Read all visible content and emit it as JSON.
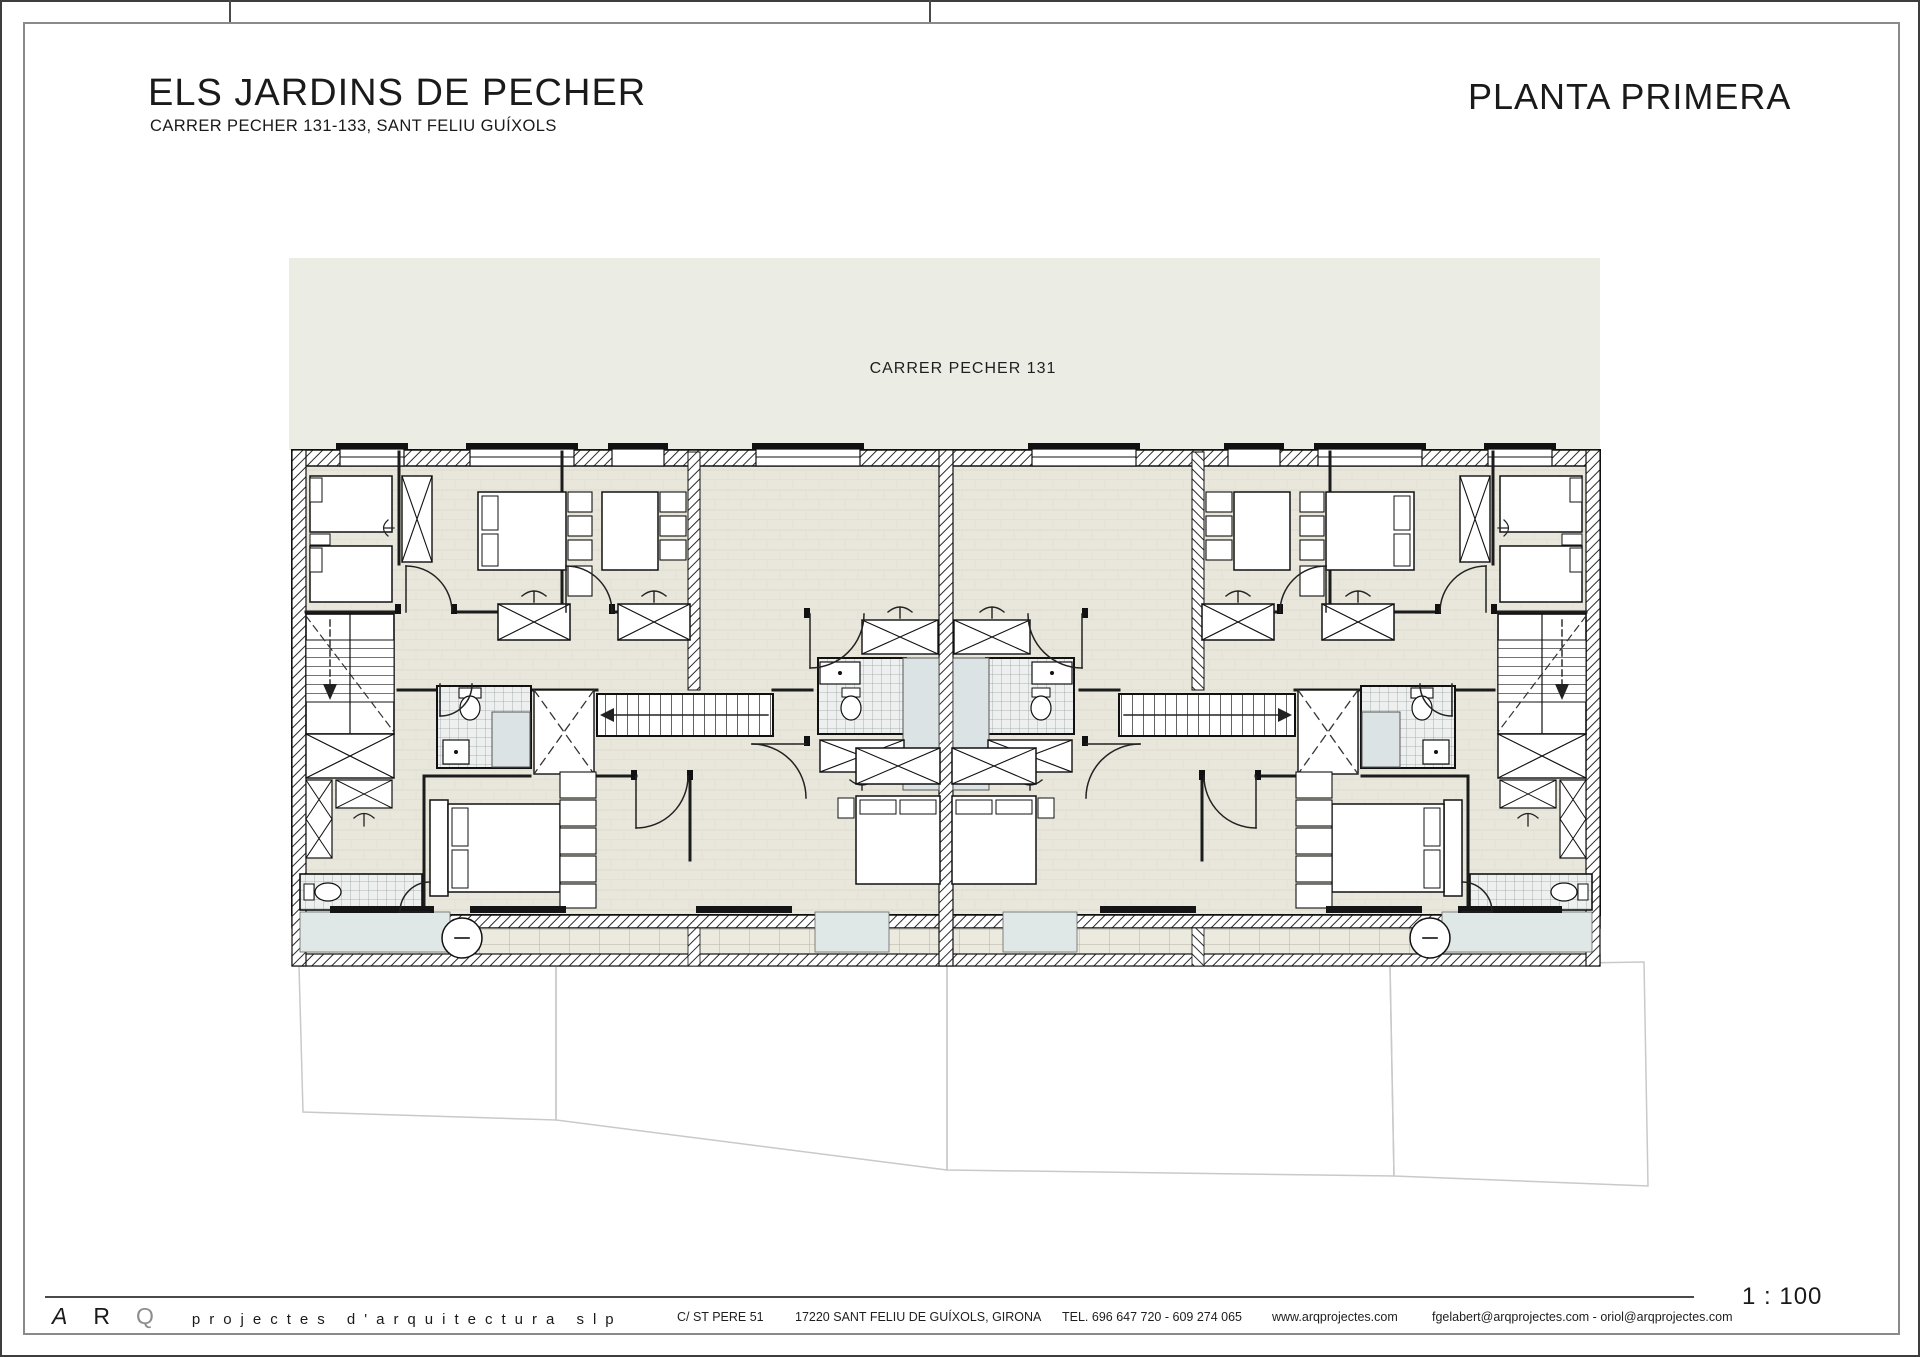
{
  "header": {
    "project_title": "ELS JARDINS DE PECHER",
    "project_subtitle": "CARRER PECHER 131-133, SANT FELIU GUÍXOLS",
    "plan_title": "PLANTA PRIMERA"
  },
  "plan": {
    "street_label": "CARRER PECHER 131",
    "scale_label": "1 : 100"
  },
  "colors": {
    "street_band": "#ebece4",
    "floor": "#e9e7dc",
    "floor_joint": "#ddd9cc",
    "wall_line": "#1a1a1a",
    "bath_tile_bg": "#eef0ef",
    "bath_tile_line": "#97a1a1",
    "shower": "#dce3e5",
    "terrace_blue": "#dfe7e7",
    "balcony_tile": "#eceadf",
    "balcony_tile_line": "#b3b0a4",
    "plot_line": "#c9c9c9",
    "frame": "#8a8a8a"
  },
  "footer": {
    "logo_a": "A",
    "logo_r": "R",
    "logo_q": "Q",
    "logo_slogan": "projectes d'arquitectura slp",
    "address": "C/ ST PERE 51",
    "city": "17220 SANT FELIU DE GUÍXOLS, GIRONA",
    "phone": "TEL. 696 647 720 - 609 274 065",
    "website": "www.arqprojectes.com",
    "emails": "fgelabert@arqprojectes.com - oriol@arqprojectes.com"
  }
}
